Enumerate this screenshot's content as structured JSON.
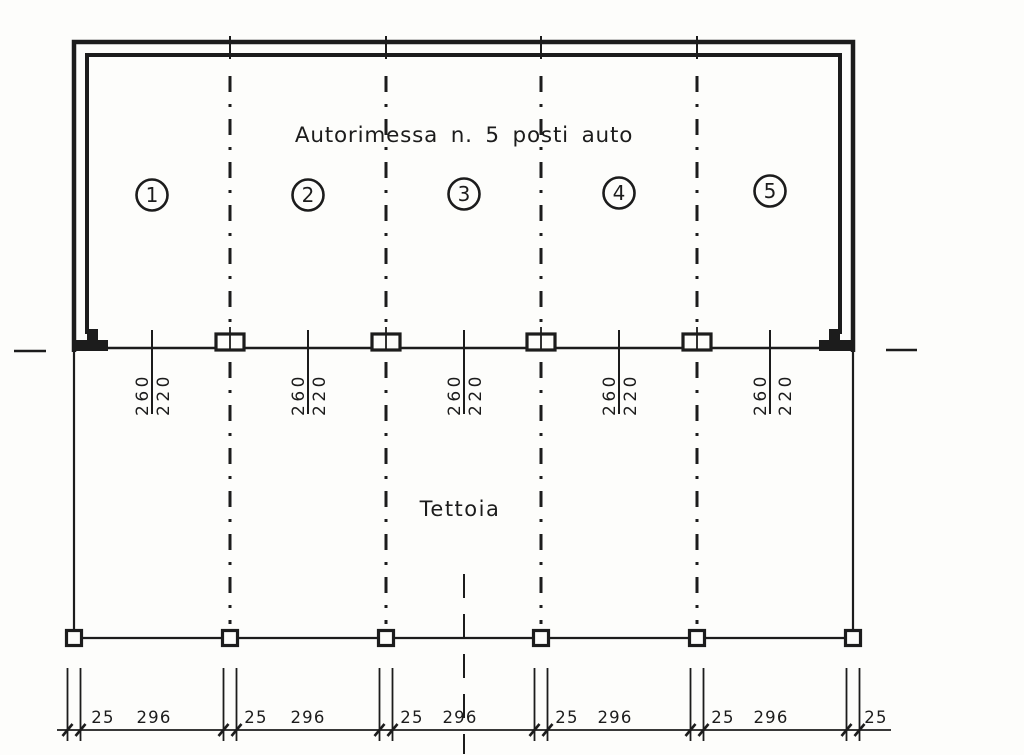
{
  "colors": {
    "ink": "#1c1c1c",
    "paper": "#fdfdfb"
  },
  "garage": {
    "title": "Autorimessa n. 5 posti auto",
    "bays": [
      {
        "number": "1",
        "door_dim_left": "260",
        "door_dim_right": "220"
      },
      {
        "number": "2",
        "door_dim_left": "260",
        "door_dim_right": "220"
      },
      {
        "number": "3",
        "door_dim_left": "260",
        "door_dim_right": "220"
      },
      {
        "number": "4",
        "door_dim_left": "260",
        "door_dim_right": "220"
      },
      {
        "number": "5",
        "door_dim_left": "260",
        "door_dim_right": "220"
      }
    ]
  },
  "canopy": {
    "label": "Tettoia"
  },
  "dimension_chain": {
    "segments": [
      {
        "post_width": "25",
        "span": "296"
      },
      {
        "post_width": "25",
        "span": "296"
      },
      {
        "post_width": "25",
        "span": "296"
      },
      {
        "post_width": "25",
        "span": "296"
      },
      {
        "post_width": "25",
        "span": "296"
      }
    ],
    "closing_post_width": "25"
  }
}
